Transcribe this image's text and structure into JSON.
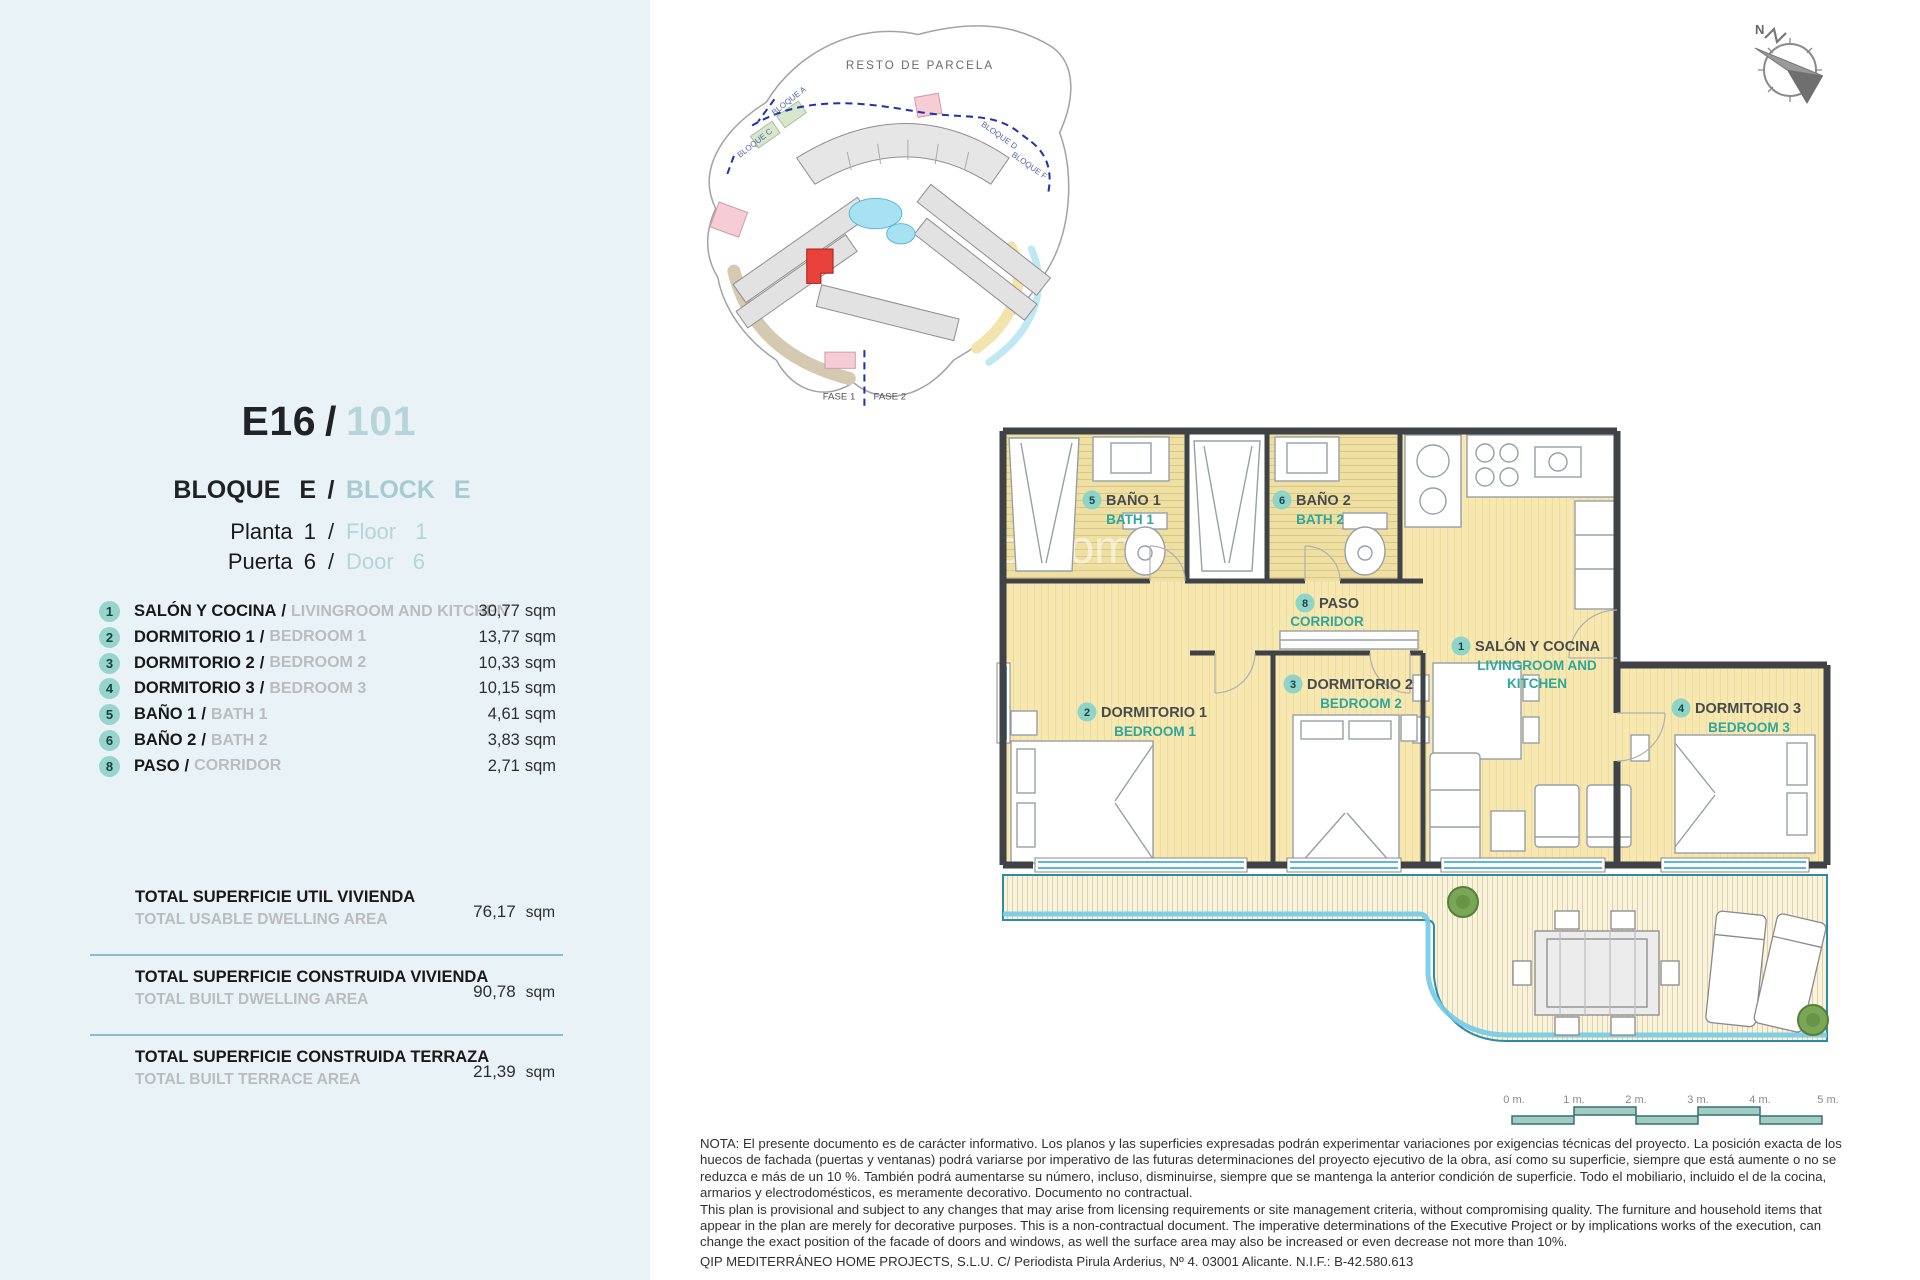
{
  "sep": "/",
  "area_unit": "sqm",
  "header": {
    "unit_code": "E16",
    "unit_number": "101",
    "block_es": "BLOQUE E",
    "block_en": "BLOCK E",
    "floor_es": "Planta 1",
    "floor_en": "Floor 1",
    "door_es": "Puerta 6",
    "door_en": "Door 6"
  },
  "rooms": [
    {
      "num": "1",
      "es": "SALÓN Y COCINA",
      "en": "LIVINGROOM AND KITCHEN",
      "area": "30,77"
    },
    {
      "num": "2",
      "es": "DORMITORIO 1",
      "en": "BEDROOM 1",
      "area": "13,77"
    },
    {
      "num": "3",
      "es": "DORMITORIO 2",
      "en": "BEDROOM 2",
      "area": "10,33"
    },
    {
      "num": "4",
      "es": "DORMITORIO 3",
      "en": "BEDROOM 3",
      "area": "10,15"
    },
    {
      "num": "5",
      "es": "BAÑO 1",
      "en": "BATH 1",
      "area": "4,61"
    },
    {
      "num": "6",
      "es": "BAÑO 2",
      "en": "BATH 2",
      "area": "3,83"
    },
    {
      "num": "8",
      "es": "PASO",
      "en": "CORRIDOR",
      "area": "2,71"
    }
  ],
  "totals": [
    {
      "es": "TOTAL SUPERFICIE UTIL VIVIENDA",
      "en": "TOTAL USABLE DWELLING AREA",
      "area": "76,17"
    },
    {
      "es": "TOTAL SUPERFICIE CONSTRUIDA VIVIENDA",
      "en": "TOTAL BUILT DWELLING AREA",
      "area": "90,78"
    },
    {
      "es": "TOTAL SUPERFICIE CONSTRUIDA TERRAZA",
      "en": "TOTAL BUILT TERRACE AREA",
      "area": "21,39"
    }
  ],
  "floor_plan": {
    "living_en_line1": "LIVINGROOM AND",
    "living_en_line2": "KITCHEN",
    "watermark": "ol.com"
  },
  "site_plan": {
    "resto": "RESTO DE PARCELA",
    "fase1": "FASE 1",
    "fase2": "FASE 2",
    "blocks": [
      "BLOQUE A",
      "BLOQUE C",
      "BLOQUE D",
      "BLOQUE F"
    ]
  },
  "compass": {
    "north": "N"
  },
  "scale_bar": {
    "labels": [
      "0 m.",
      "1 m.",
      "2 m.",
      "3 m.",
      "4 m.",
      "5 m."
    ]
  },
  "disclaimer": {
    "lines": [
      "NOTA: El presente documento es de carácter informativo. Los planos y las superficies expresadas podrán experimentar variaciones por exigencias técnicas del proyecto. La posición exacta de los",
      "huecos de fachada (puertas y ventanas) podrá variarse por imperativo de las futuras determinaciones del proyecto ejecutivo de la obra, así como su superficie, siempre que está aumente o no se",
      "reduzca e más de un 10 %. También podrá aumentarse su número, incluso, disminuirse, siempre que se mantenga la anterior condición de superficie. Todo el mobiliario, incluido el de la cocina,",
      "armarios y electrodomésticos, es meramente decorativo. Documento no contractual.",
      "This plan is provisional and subject to any changes that may arise from licensing requirements or site management criteria, without compromising quality. The furniture and household items that",
      "appear in the plan are merely for decorative purposes. This is a non-contractual document. The imperative determinations of the Executive Project or by implications works of the execution, can",
      "change the exact position of the facade of doors and windows, as well the surface area may also be increased or even decrease not more than 10%.",
      "QIP MEDITERRÁNEO HOME PROJECTS, S.L.U. C/ Periodista Pirula Arderius, Nº 4. 03001 Alicante. N.I.F.: B-42.580.613"
    ]
  },
  "colors": {
    "panel_bg": "#e9f2f6",
    "badge_teal": "#97d5cc",
    "accent_teal": "#2ea69b",
    "header_teal": "#aed0d6",
    "gray_en": "#b9bdc0",
    "divider": "#8abccb",
    "room_fill": "#f7e7b0",
    "wall": "#3f4347",
    "window_blue": "#5ab8e0",
    "highlight_red": "#e8413c"
  }
}
